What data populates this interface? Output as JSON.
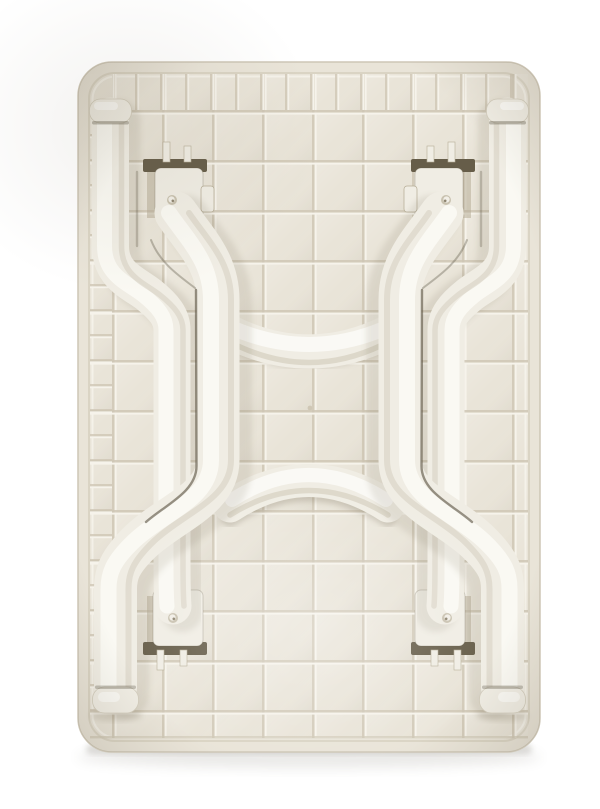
{
  "scene": {
    "description": "Product photo: underside of a white plastic folding table lying flat on a pure white background, with four tubular legs folded flat, four hinge brackets, two curved cross-braces, and a molded waffle rib grid.",
    "subject": "folding-table-underside",
    "title": "White folding table, underside view with folded legs",
    "objects": {
      "tabletop": "rectangular molded tabletop underside with rib grid and rounded corners",
      "legs": [
        "top-left folded leg",
        "top-right folded leg",
        "bottom-left folded leg",
        "bottom-right folded leg"
      ],
      "cross_braces": [
        "upper curved brace (bows down)",
        "lower curved brace (bows up)"
      ],
      "hinge_brackets": [
        "top-left",
        "top-right",
        "bottom-left",
        "bottom-right"
      ],
      "foot_caps": [
        "top-left",
        "top-right",
        "bottom-left",
        "bottom-right"
      ],
      "center_mark": "small molding sprue nub at grid center"
    },
    "counts": {
      "legs": 4,
      "hinge_brackets": 4,
      "hinge_pins": 4,
      "foot_caps": 4,
      "cross_braces": 2,
      "grid_columns": 8,
      "grid_rows": 12
    }
  },
  "colors": {
    "background": "#ffffff",
    "table_face": "#e9e4d8",
    "table_edge": "#cdc6b6",
    "groove_dark": "#cfc7b5",
    "groove_light": "#f6f3eb",
    "rim_shadow": "#d6cfbf",
    "rim_highlight": "#f5f2ea",
    "tube_base": "#f0ede4",
    "tube_highlight": "#fbfaf6",
    "tube_shade": "#d2ccbc",
    "crease_dark": "#564f3e",
    "recess_dark": "#665d49",
    "recess_mid": "#b6ad97",
    "pin_ring": "#c9c2b0",
    "pin_face": "#f2efe7",
    "pin_center": "#8d8470",
    "cast_shadow": "#6b6148",
    "drop_shadow": "#55503f"
  }
}
